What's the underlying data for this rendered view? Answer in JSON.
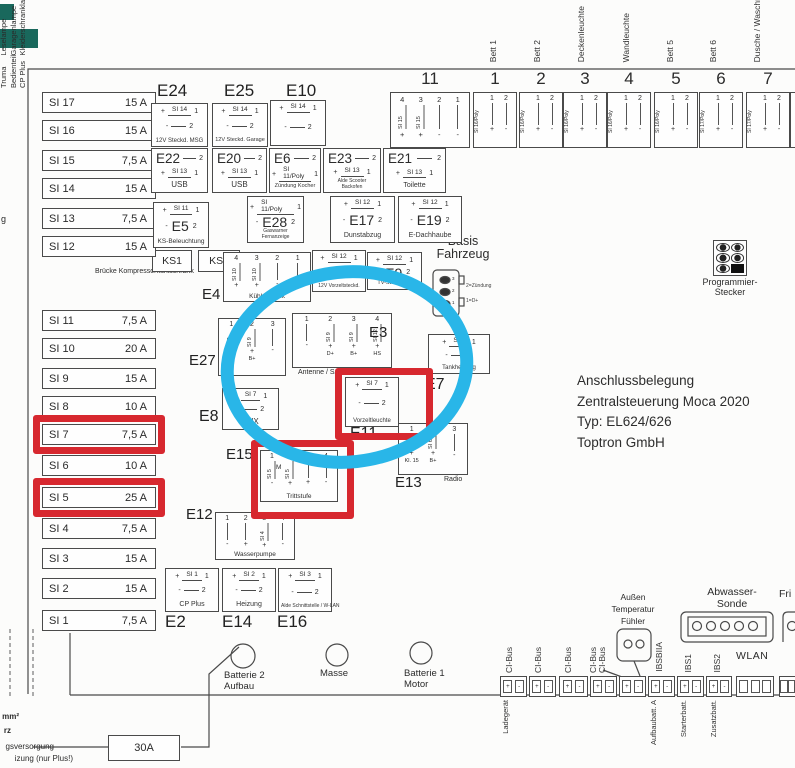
{
  "colors": {
    "red_annotation": "#d7282f",
    "blue_annotation": "#29b6e8",
    "line": "#4a4a4a",
    "teal_swatch": "#19685c"
  },
  "title_block": {
    "line1": "Anschlussbelegung",
    "line2": "Zentralsteuerung Moca 2020",
    "line3": "Typ: EL624/626",
    "line4": "Toptron GmbH"
  },
  "signs": {
    "plus": "+",
    "minus": "-"
  },
  "pin_digits": [
    "1",
    "2"
  ],
  "fuses": [
    {
      "id": "SI 17",
      "amp": "15 A"
    },
    {
      "id": "SI 16",
      "amp": "15 A"
    },
    {
      "id": "SI 15",
      "amp": "7,5 A"
    },
    {
      "id": "SI 14",
      "amp": "15 A"
    },
    {
      "id": "SI 13",
      "amp": "7,5 A"
    },
    {
      "id": "SI 12",
      "amp": "15 A"
    },
    {
      "id": "SI 11",
      "amp": "7,5 A"
    },
    {
      "id": "SI 10",
      "amp": "20 A"
    },
    {
      "id": "SI 9",
      "amp": "15 A"
    },
    {
      "id": "SI 8",
      "amp": "10 A"
    },
    {
      "id": "SI 7",
      "amp": "7,5 A",
      "highlighted": true
    },
    {
      "id": "SI 6",
      "amp": "10 A"
    },
    {
      "id": "SI 5",
      "amp": "25 A",
      "highlighted": true
    },
    {
      "id": "SI 4",
      "amp": "7,5 A"
    },
    {
      "id": "SI 3",
      "amp": "15 A"
    },
    {
      "id": "SI 2",
      "amp": "15 A"
    },
    {
      "id": "SI 1",
      "amp": "7,5 A"
    }
  ],
  "simple_boxes": [
    {
      "id": "E24",
      "fuse": "SI 14",
      "caption": "12V Steckd. MSG"
    },
    {
      "id": "E25",
      "fuse": "SI 14",
      "caption": "12V Steckd. Garage"
    },
    {
      "id": "E10",
      "fuse": "SI 14",
      "caption": ""
    },
    {
      "id": "E22",
      "fuse": "SI 13",
      "caption": "USB"
    },
    {
      "id": "E20",
      "fuse": "SI 13",
      "caption": "USB"
    },
    {
      "id": "E6",
      "fuse": "SI 11/Poly",
      "caption": "Zündung Kocher"
    },
    {
      "id": "E23",
      "fuse": "SI 13",
      "caption": "Alde Scooter Backofen"
    },
    {
      "id": "E21",
      "fuse": "SI 13",
      "caption": "Toilette"
    },
    {
      "id": "E5",
      "fuse": "SI 11",
      "caption": "KS-Beleuchtung"
    },
    {
      "id": "E28",
      "fuse": "SI 11/Poly",
      "caption": "Gaswarner Fernanzeige"
    },
    {
      "id": "E17",
      "fuse": "SI 12",
      "caption": "Dunstabzug"
    },
    {
      "id": "E19",
      "fuse": "SI 12",
      "caption": "E-Dachhaube"
    },
    {
      "id": "E18",
      "fuse": "SI 12",
      "caption": "12V Vorzeltsteckd."
    },
    {
      "id": "E9",
      "fuse": "SI 12",
      "caption": "TV-Steckdose"
    },
    {
      "id": "E7",
      "fuse": "SI 8",
      "caption": "Tankheizung"
    },
    {
      "id": "E11",
      "fuse": "SI 7",
      "caption": "Vorzeltleuchte",
      "highlighted": true
    },
    {
      "id": "E8",
      "fuse": "SI 7",
      "caption": "AUX"
    },
    {
      "id": "E2",
      "fuse": "SI 1",
      "caption": "CP Plus"
    },
    {
      "id": "E14",
      "fuse": "SI 2",
      "caption": "Heizung"
    },
    {
      "id": "E16",
      "fuse": "SI 3",
      "caption": "Alde Schnittstelle / W-LAN"
    }
  ],
  "pin_boxes": [
    {
      "id": "E4",
      "caption": "Kühlschrank",
      "cols": [
        {
          "pin": "4",
          "fuse": "SI 10",
          "sign": "+",
          "bottom": ""
        },
        {
          "pin": "3",
          "fuse": "SI 10",
          "sign": "+",
          "bottom": ""
        },
        {
          "pin": "2",
          "fuse": "",
          "sign": "-",
          "bottom": ""
        },
        {
          "pin": "1",
          "fuse": "",
          "sign": "-",
          "bottom": ""
        }
      ]
    },
    {
      "id": "E27",
      "caption": "",
      "cols": [
        {
          "pin": "1",
          "fuse": "SI 9",
          "sign": "+",
          "bottom": "D+"
        },
        {
          "pin": "2",
          "fuse": "SI 9",
          "sign": "+",
          "bottom": "B+"
        },
        {
          "pin": "3",
          "fuse": "",
          "sign": "-",
          "bottom": ""
        }
      ]
    },
    {
      "id": "E3",
      "caption": "Antenne / SAT",
      "cols": [
        {
          "pin": "1",
          "fuse": "",
          "sign": "-",
          "bottom": ""
        },
        {
          "pin": "2",
          "fuse": "SI 9",
          "sign": "+",
          "bottom": "D+"
        },
        {
          "pin": "3",
          "fuse": "SI 9",
          "sign": "+",
          "bottom": "B+"
        },
        {
          "pin": "4",
          "fuse": "SI 12",
          "sign": "+",
          "bottom": "HS"
        }
      ]
    },
    {
      "id": "E13",
      "caption": "Radio",
      "cols": [
        {
          "pin": "1",
          "fuse": "SI 6",
          "sign": "+",
          "bottom": "Kl. 15"
        },
        {
          "pin": "2",
          "fuse": "SI 6",
          "sign": "+",
          "bottom": "B+"
        },
        {
          "pin": "3",
          "fuse": "",
          "sign": "-",
          "bottom": ""
        }
      ]
    },
    {
      "id": "E15",
      "caption": "Trittstufe",
      "symbol": "M",
      "highlighted": true,
      "cols": [
        {
          "pin": "1",
          "fuse": "SI 5",
          "sign": "-",
          "bottom": ""
        },
        {
          "pin": "2",
          "fuse": "SI 5",
          "sign": "+",
          "bottom": ""
        },
        {
          "pin": "3",
          "fuse": "",
          "sign": "+",
          "bottom": ""
        },
        {
          "pin": "4",
          "fuse": "",
          "sign": "-",
          "bottom": ""
        }
      ]
    },
    {
      "id": "E12",
      "caption": "Wasserpumpe",
      "cols": [
        {
          "pin": "1",
          "fuse": "",
          "sign": "-",
          "bottom": ""
        },
        {
          "pin": "2",
          "fuse": "",
          "sign": "+",
          "bottom": ""
        },
        {
          "pin": "3",
          "fuse": "SI 4",
          "sign": "+",
          "bottom": ""
        },
        {
          "pin": "4",
          "fuse": "",
          "sign": "-",
          "bottom": ""
        }
      ]
    }
  ],
  "top_row": {
    "block11": {
      "number": "11",
      "pins": [
        "4",
        "3",
        "2",
        "1"
      ],
      "fuses": [
        "SI 15",
        "SI 15",
        "",
        ""
      ],
      "signs": [
        "+",
        "+",
        "-",
        "-"
      ],
      "room_lines": [
        "Leselampe",
        "Garagenlampe",
        "Kleiderschrankla"
      ]
    },
    "outlets": [
      {
        "number": "1",
        "fuse": "SI 16/Poly",
        "room": "Bett 1"
      },
      {
        "number": "2",
        "fuse": "SI 16/Poly",
        "room": "Bett 2"
      },
      {
        "number": "3",
        "fuse": "SI 16/Poly",
        "room": "Deckenleuchte"
      },
      {
        "number": "4",
        "fuse": "SI 16/Poly",
        "room": "Wandleuchte"
      },
      {
        "number": "5",
        "fuse": "SI 16/Poly",
        "room": "Bett 5"
      },
      {
        "number": "6",
        "fuse": "SI 17/Poly",
        "room": "Bett 6"
      },
      {
        "number": "7",
        "fuse": "SI 17/Poly",
        "room": "Dusche / Waschr"
      }
    ]
  },
  "ks": {
    "box1": "KS1",
    "box2": "KS2",
    "note_line1": "KS1 / KS2:",
    "note_line2": "Brücke Kompressorkühlschrank"
  },
  "basis": {
    "title": "Basis\nFahrzeug",
    "pin_numbers": [
      "3",
      "2",
      "1"
    ],
    "note1": "2=Zündung",
    "note2": "1=D+"
  },
  "programmier": {
    "caption": "Programmier-\nStecker"
  },
  "power": {
    "battery2": "Batterie 2\nAufbau",
    "masse": "Masse",
    "battery1": "Batterie 1\nMotor",
    "fuse_30a": "30A",
    "cut_text1": "mm²",
    "cut_text2": "rz",
    "cut_text3": "gsversorgung",
    "cut_text4": "izung (nur Plus!)",
    "cut_text5": "g"
  },
  "bottom_bus": {
    "ci_labels": [
      "CI-Bus",
      "CI-Bus",
      "CI-Bus",
      "CI-Bus",
      "CI-Bus"
    ],
    "ibsb": "IBSBIIA",
    "ibs1": "IBS1",
    "ibs2": "IBS2",
    "wlan": "WLAN",
    "aussen": "Außen\nTemperatur\nFühler",
    "abwasser": "Abwasser-\nSonde",
    "fri": "Fri",
    "slot_signs": [
      "+",
      "-"
    ],
    "below": [
      "Ladegerät",
      "Truma\nBedienteil\nCP Plus",
      "Aufbaubatt. A",
      "Starterbatt.",
      "Zusatzbatt."
    ]
  },
  "annotations": {
    "red_marked": [
      "SI 7",
      "SI 5",
      "E11",
      "E15"
    ],
    "blue_circled": "Antenne/SAT + E3 area"
  }
}
